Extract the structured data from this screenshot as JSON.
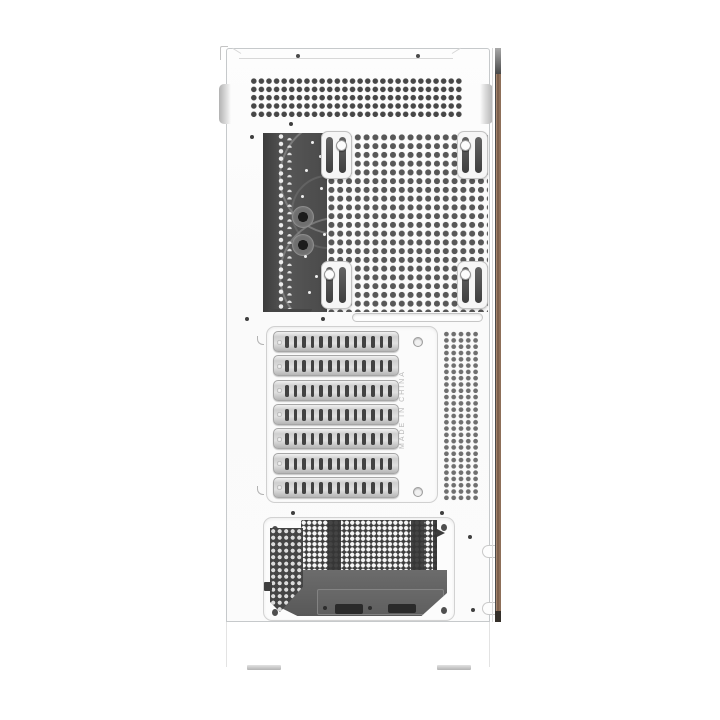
{
  "product_photo": {
    "subject": "White ATX PC tower case, side rear-panel product view",
    "markings": {
      "made_in_label": "MADE IN CHINA"
    },
    "features": {
      "expansion_slot_count": 7,
      "slots_per_cover": 13,
      "fan_hub_count": 2,
      "fan_rail_bracket_count": 4,
      "feet_count": 2
    },
    "colors": {
      "background": "#ffffff",
      "case_white": "#fcfcfc",
      "outline_gray": "#c6c9cb",
      "vent_hole_dark": "#474747",
      "mesh_hole_gray": "#585858",
      "fan_body_dark": "#4a4a4a",
      "psu_dark": "#3e3e3e",
      "psu_bracket_gray": "#616161",
      "trim_brown": "#8d6f59",
      "feet_gray": "#b3b3b3"
    }
  }
}
